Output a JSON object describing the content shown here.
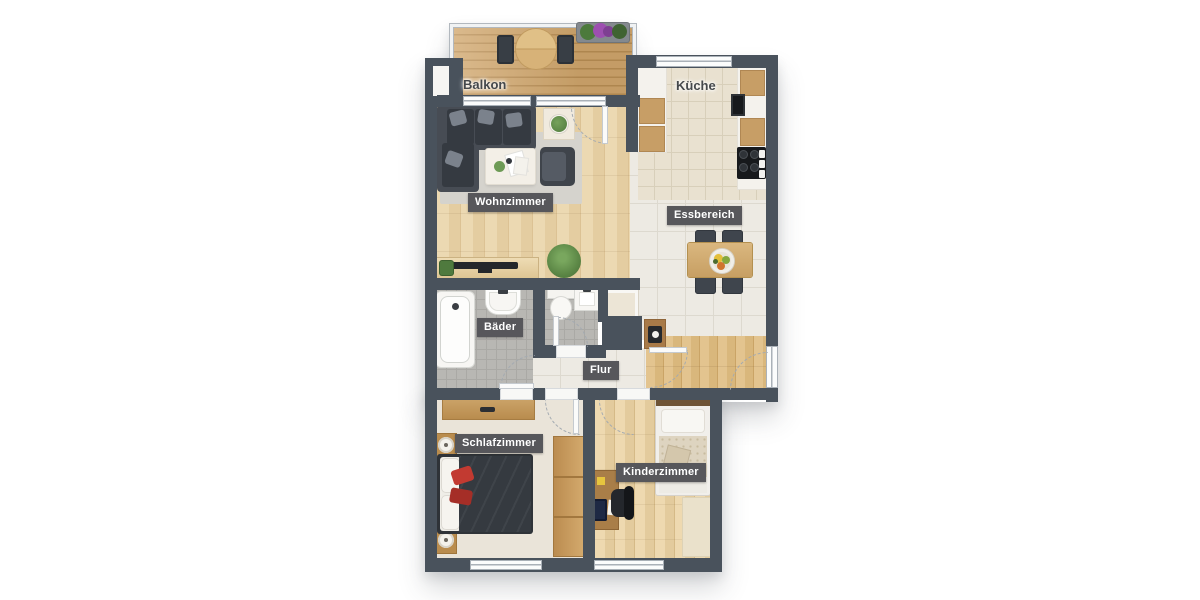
{
  "floorplan": {
    "rooms": [
      {
        "id": "balkon",
        "label": "Balkon"
      },
      {
        "id": "kueche",
        "label": "Küche"
      },
      {
        "id": "wohnzimmer",
        "label": "Wohnzimmer"
      },
      {
        "id": "essbereich",
        "label": "Essbereich"
      },
      {
        "id": "baeder",
        "label": "Bäder"
      },
      {
        "id": "flur",
        "label": "Flur"
      },
      {
        "id": "schlafzimmer",
        "label": "Schlafzimmer"
      },
      {
        "id": "kinderzimmer",
        "label": "Kinderzimmer"
      }
    ],
    "colors": {
      "wall": "#49525c",
      "label_chip_bg": "#57575b",
      "label_chip_text": "#ffffff",
      "room_name_text": "#45484b",
      "deck_wood": "#cda268",
      "interior_wood": "#e7d2a8",
      "tile_beige": "#eae3d4",
      "tile_gray": "#b8b7b3",
      "carpet_cream": "#eae4d9",
      "accent_red": "#c23a31",
      "plant_green": "#5f8a48",
      "flower_purple": "#9d4fb0"
    },
    "furniture": [
      "sectional-sofa",
      "coffee-table",
      "armchair",
      "side-table",
      "tv-sideboard",
      "potted-plant",
      "balcony-round-table",
      "balcony-chairs",
      "flower-planter",
      "kitchen-counters",
      "stove",
      "dining-table",
      "dining-chairs",
      "fruit-bowl",
      "bathtub",
      "washbasin",
      "toilet",
      "wc-basin",
      "hall-closet",
      "console-table",
      "double-bed",
      "nightstand-lamps",
      "dresser",
      "wardrobe",
      "single-bed",
      "desk",
      "desk-chair",
      "kids-rug"
    ]
  }
}
